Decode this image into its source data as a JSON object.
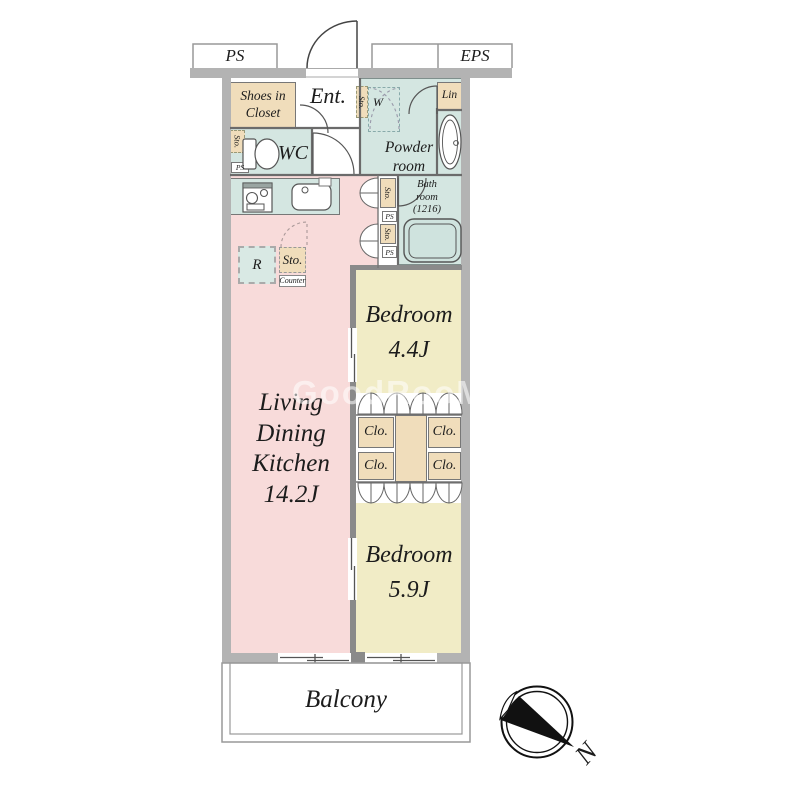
{
  "rooms": {
    "ldk": {
      "lines": [
        "Living",
        "Dining",
        "Kitchen",
        "14.2J"
      ]
    },
    "bedroom_top": {
      "name": "Bedroom",
      "size": "4.4J"
    },
    "bedroom_bottom": {
      "name": "Bedroom",
      "size": "5.9J"
    },
    "balcony": "Balcony",
    "entrance": "Ent.",
    "wc": "WC",
    "powder_room": [
      "Powder",
      "room"
    ],
    "bath_room": [
      "Bath",
      "room",
      "(1216)"
    ],
    "shoes_closet": [
      "Shoes in",
      "Closet"
    ],
    "linen": "Lin"
  },
  "fixtures": {
    "storage": "Sto.",
    "closet": "Clo.",
    "refrigerator": "R",
    "counter": "Counter",
    "washer": "W",
    "pipe_space": "PS",
    "electrical_pipe_space": "EPS"
  },
  "compass": {
    "north": "N"
  },
  "watermark": "GoodRooM",
  "colors": {
    "ldk_pink": "#f8dbda",
    "bedroom_cream": "#f1ecc6",
    "wet_area_teal": "#d4e6e1",
    "closet_beige": "#f0ddbb",
    "wall_gray": "#b3b3b3"
  }
}
